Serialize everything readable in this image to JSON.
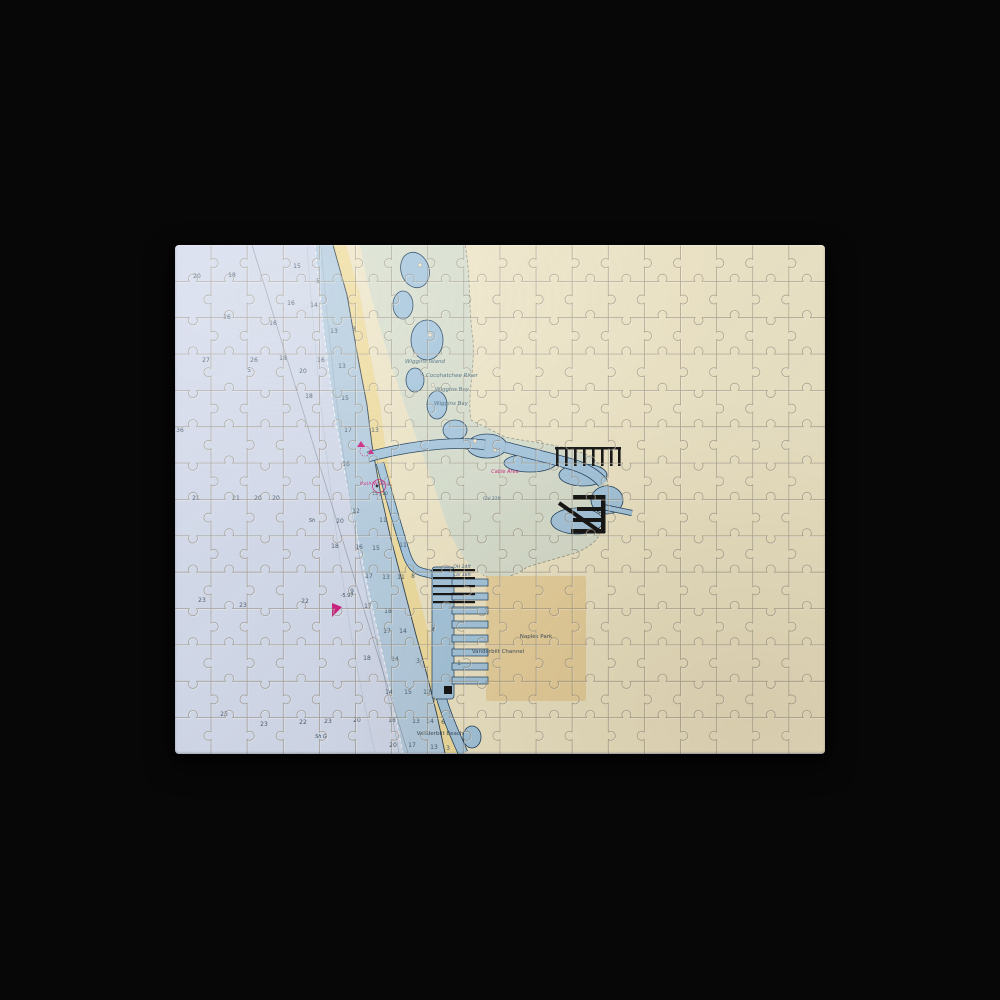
{
  "scene": {
    "background_color": "#070707",
    "object": "jigsaw-puzzle-nautical-chart"
  },
  "puzzle": {
    "cols": 18,
    "rows": 14,
    "line_dark": "rgba(104,91,64,0.48)",
    "line_light": "rgba(255,255,255,0.5)"
  },
  "chart": {
    "colors": {
      "offshore": "#d4dbec",
      "nearshore": "#b7cfe2",
      "beach": "#f2dfa0",
      "land": "#f1e8c9",
      "estuary": "#dae1d0",
      "waterway": "#a7c8e0",
      "outline": "#1d3e5c",
      "magenta": "#cf1f7e",
      "blue_note": "#3a5f8a",
      "tan_overlay": "#ebd29b",
      "sounding": "#4a5d6e",
      "label": "#44687c",
      "dark_label": "#3d4f5c",
      "structure": "#121212"
    },
    "labels": [
      {
        "text": "Wiggins Island",
        "x": 250,
        "y": 118,
        "c": "label",
        "s": 5.5,
        "i": 1
      },
      {
        "text": "Cocohatchee River",
        "x": 277,
        "y": 132,
        "c": "label",
        "s": 5.5,
        "i": 1
      },
      {
        "text": "Wiggins Bay",
        "x": 277,
        "y": 146,
        "c": "label",
        "s": 5.5,
        "i": 1
      },
      {
        "text": "Wiggins Bay",
        "x": 276,
        "y": 160,
        "c": "label",
        "s": 5.5,
        "i": 1
      },
      {
        "text": "Cable Area",
        "x": 330,
        "y": 228,
        "c": "magenta",
        "s": 5,
        "i": 1
      },
      {
        "text": "Cbl 21ft",
        "x": 317,
        "y": 255,
        "c": "blue_note",
        "s": 4.5,
        "i": 1
      },
      {
        "text": "OH 24ft",
        "x": 287,
        "y": 323,
        "c": "blue_note",
        "s": 4.5,
        "i": 1
      },
      {
        "text": "Cbl 18ft",
        "x": 287,
        "y": 331,
        "c": "blue_note",
        "s": 4.5,
        "i": 1
      },
      {
        "text": "Naples Park",
        "x": 361,
        "y": 393,
        "c": "dark_label",
        "s": 5.5,
        "i": 0
      },
      {
        "text": "Vanderbilt Channel",
        "x": 323,
        "y": 408,
        "c": "dark_label",
        "s": 5.5,
        "i": 0
      },
      {
        "text": "Vanderbilt Beach",
        "x": 265,
        "y": 490,
        "c": "dark_label",
        "s": 5.5,
        "i": 0
      },
      {
        "text": "Mo(A)W BELL",
        "x": 200,
        "y": 240,
        "c": "magenta",
        "s": 4.5,
        "i": 0
      },
      {
        "text": "15 | 10",
        "x": 205,
        "y": 250,
        "c": "dark_label",
        "s": 4.5,
        "i": 0
      },
      {
        "text": "Sh G",
        "x": 146,
        "y": 493,
        "c": "dark_label",
        "s": 5,
        "i": 1
      },
      {
        "text": "Sh",
        "x": 137,
        "y": 277,
        "c": "dark_label",
        "s": 5,
        "i": 1
      },
      {
        "text": "-5.97",
        "x": 172,
        "y": 352,
        "c": "dark_label",
        "s": 5,
        "i": 0
      }
    ],
    "soundings": [
      {
        "v": "20",
        "x": 22,
        "y": 33
      },
      {
        "v": "18",
        "x": 57,
        "y": 32
      },
      {
        "v": "15",
        "x": 122,
        "y": 23
      },
      {
        "v": "5",
        "x": 143,
        "y": 38
      },
      {
        "v": "16",
        "x": 116,
        "y": 60
      },
      {
        "v": "14",
        "x": 139,
        "y": 62
      },
      {
        "v": "26",
        "x": 52,
        "y": 74
      },
      {
        "v": "16",
        "x": 98,
        "y": 80
      },
      {
        "v": "13",
        "x": 159,
        "y": 88
      },
      {
        "v": "8",
        "x": 179,
        "y": 86
      },
      {
        "v": "27",
        "x": 31,
        "y": 117
      },
      {
        "v": "26",
        "x": 79,
        "y": 117
      },
      {
        "v": "18",
        "x": 108,
        "y": 115
      },
      {
        "v": "16",
        "x": 146,
        "y": 117
      },
      {
        "v": "13",
        "x": 167,
        "y": 123
      },
      {
        "v": "5",
        "x": 74,
        "y": 127
      },
      {
        "v": "20",
        "x": 128,
        "y": 128
      },
      {
        "v": "18",
        "x": 134,
        "y": 153
      },
      {
        "v": "15",
        "x": 170,
        "y": 155
      },
      {
        "v": "36",
        "x": 5,
        "y": 187
      },
      {
        "v": "17",
        "x": 173,
        "y": 187
      },
      {
        "v": "13",
        "x": 200,
        "y": 187
      },
      {
        "v": "16",
        "x": 171,
        "y": 221
      },
      {
        "v": "21",
        "x": 21,
        "y": 255
      },
      {
        "v": "21",
        "x": 61,
        "y": 255
      },
      {
        "v": "20",
        "x": 83,
        "y": 255
      },
      {
        "v": "20",
        "x": 101,
        "y": 255
      },
      {
        "v": "12",
        "x": 181,
        "y": 268
      },
      {
        "v": "11",
        "x": 208,
        "y": 277
      },
      {
        "v": "20",
        "x": 165,
        "y": 278
      },
      {
        "v": "18",
        "x": 160,
        "y": 303
      },
      {
        "v": "16",
        "x": 184,
        "y": 304
      },
      {
        "v": "15",
        "x": 201,
        "y": 305
      },
      {
        "v": "11",
        "x": 228,
        "y": 302
      },
      {
        "v": "17",
        "x": 194,
        "y": 333
      },
      {
        "v": "13",
        "x": 211,
        "y": 334
      },
      {
        "v": "11",
        "x": 226,
        "y": 334
      },
      {
        "v": "8",
        "x": 238,
        "y": 333
      },
      {
        "v": "9",
        "x": 177,
        "y": 348
      },
      {
        "v": "23",
        "x": 27,
        "y": 357
      },
      {
        "v": "23",
        "x": 68,
        "y": 362
      },
      {
        "v": "22",
        "x": 130,
        "y": 358
      },
      {
        "v": "17",
        "x": 193,
        "y": 363
      },
      {
        "v": "18",
        "x": 213,
        "y": 368
      },
      {
        "v": "17",
        "x": 212,
        "y": 388
      },
      {
        "v": "14",
        "x": 228,
        "y": 388
      },
      {
        "v": "18",
        "x": 192,
        "y": 415
      },
      {
        "v": "14",
        "x": 220,
        "y": 416
      },
      {
        "v": "4",
        "x": 258,
        "y": 387
      },
      {
        "v": "3",
        "x": 243,
        "y": 418
      },
      {
        "v": "1",
        "x": 284,
        "y": 420
      },
      {
        "v": "12",
        "x": 252,
        "y": 449
      },
      {
        "v": "23",
        "x": 49,
        "y": 471
      },
      {
        "v": "23",
        "x": 89,
        "y": 481
      },
      {
        "v": "22",
        "x": 128,
        "y": 479
      },
      {
        "v": "23",
        "x": 153,
        "y": 478
      },
      {
        "v": "20",
        "x": 182,
        "y": 477
      },
      {
        "v": "18",
        "x": 217,
        "y": 477
      },
      {
        "v": "14",
        "x": 214,
        "y": 449
      },
      {
        "v": "15",
        "x": 233,
        "y": 449
      },
      {
        "v": "13",
        "x": 241,
        "y": 478
      },
      {
        "v": "14",
        "x": 255,
        "y": 478
      },
      {
        "v": "6",
        "x": 268,
        "y": 479
      },
      {
        "v": "20",
        "x": 218,
        "y": 502
      },
      {
        "v": "17",
        "x": 237,
        "y": 502
      },
      {
        "v": "13",
        "x": 259,
        "y": 504
      },
      {
        "v": "3",
        "x": 273,
        "y": 505
      }
    ]
  }
}
